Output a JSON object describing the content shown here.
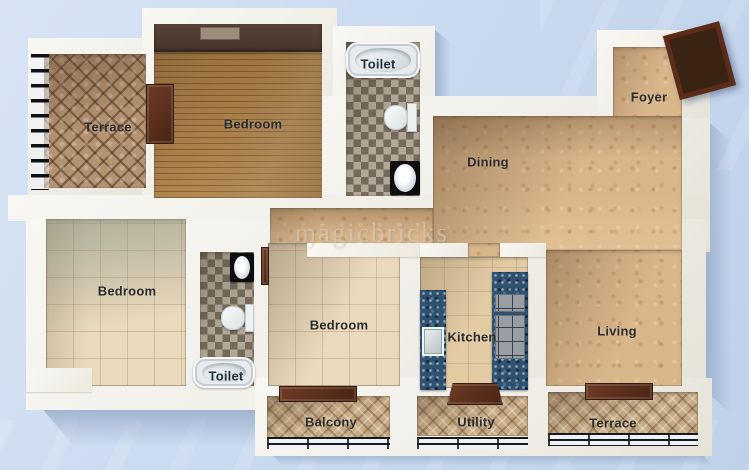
{
  "rooms": {
    "terrace_top": {
      "label": "Terrace"
    },
    "bedroom_top": {
      "label": "Bedroom"
    },
    "toilet_top": {
      "label": "Toilet"
    },
    "foyer": {
      "label": "Foyer"
    },
    "dining": {
      "label": "Dining"
    },
    "bedroom_left": {
      "label": "Bedroom"
    },
    "toilet_mid": {
      "label": "Toilet"
    },
    "bedroom_mid": {
      "label": "Bedroom"
    },
    "kitchen": {
      "label": "Kitchen"
    },
    "living": {
      "label": "Living"
    },
    "balcony": {
      "label": "Balcony"
    },
    "utility": {
      "label": "Utility"
    },
    "terrace_bottom": {
      "label": "Terrace"
    }
  },
  "watermark": {
    "text": "magicbricks",
    "echo": "magicbricks"
  },
  "colors": {
    "background_blue": "#cbdbf0",
    "wall_white": "#f5f4ef",
    "floor_tan": "#d9b58a",
    "floor_beige": "#ead9bc",
    "wood": "#a5763d",
    "checker_light": "#b3a896",
    "checker_dark": "#746a5b",
    "granite_blue": "#2f5170",
    "door_brown": "#5e3422",
    "railing_dark": "#171a1e",
    "label_text": "#2b2b2b"
  }
}
